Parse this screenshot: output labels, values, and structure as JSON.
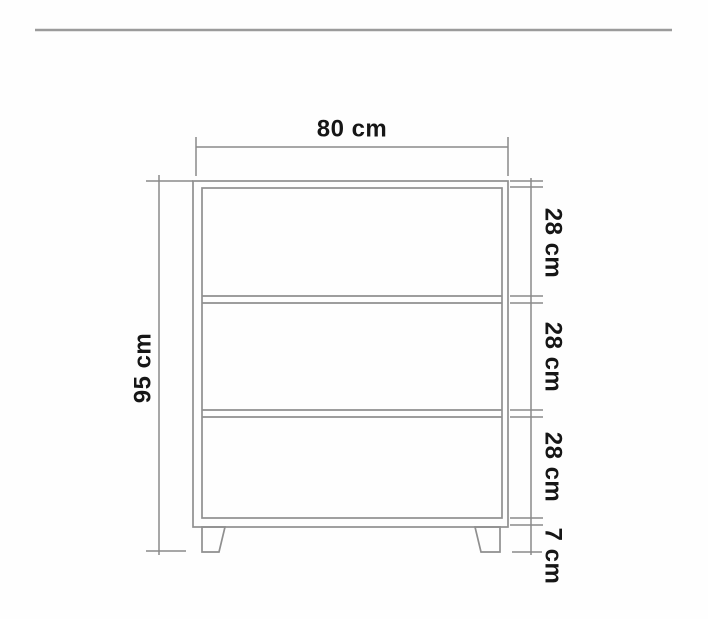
{
  "diagram": {
    "labels": {
      "width": "80 cm",
      "height": "95 cm",
      "sections": [
        {
          "label": "28 cm"
        },
        {
          "label": "28 cm"
        },
        {
          "label": "28 cm"
        },
        {
          "label": "7 cm"
        }
      ]
    },
    "colors": {
      "line": "#8f8f8f",
      "dim_line": "#8a8a8a",
      "text": "#161616",
      "rule": "#9b9b9b",
      "background": "#fefefe"
    }
  }
}
